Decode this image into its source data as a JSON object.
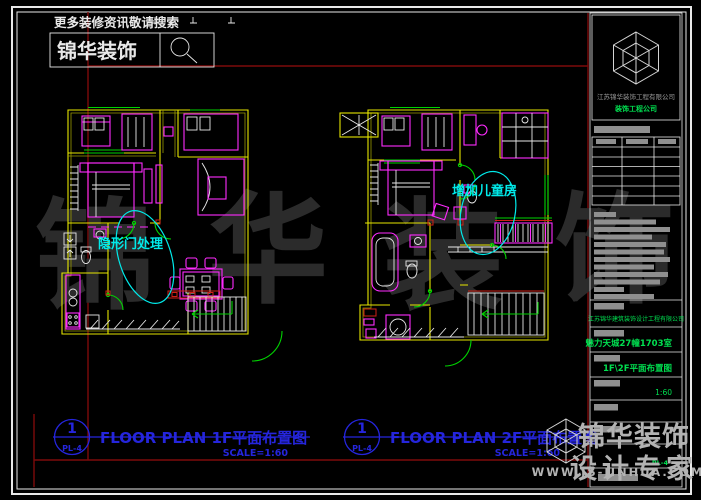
{
  "promo": {
    "hint": "更多装修资讯敬请搜索",
    "brand": "锦华装饰"
  },
  "plans": [
    {
      "bubble_no": "1",
      "bubble_ref": "PL-4",
      "title": "FLOOR PLAN 1F平面布置图",
      "scale": "SCALE=1:60",
      "annotation": "隐形门处理"
    },
    {
      "bubble_no": "1",
      "bubble_ref": "PL-4",
      "title": "FLOOR PLAN 2F平面布置图",
      "scale": "SCALE=1:60",
      "annotation": "增加儿童房"
    }
  ],
  "titleblock": {
    "company": "江苏锦华装饰工程有限公司",
    "company_sub": "装饰工程公司",
    "design_firm": "江苏锦华建筑装饰设计工程有限公司",
    "project": "魅力天城27幢1703室",
    "drawing_title": "1F\\2F平面布置图",
    "scale": "1:60",
    "sheet_no": "PL-4"
  },
  "watermarks": {
    "center_chars": [
      "锦",
      "华",
      "装",
      "饰"
    ],
    "brand": "锦华装饰",
    "tagline": "设计专家",
    "url": "WWW.JS-JINHUA.COM"
  },
  "colors": {
    "background": "#000000",
    "wall_yellow": "#e6e600",
    "furniture_magenta": "#ff2bff",
    "detail_white": "#e8e8e8",
    "door_green": "#00d400",
    "annotation_cyan": "#00eaea",
    "label_blue": "#2525dc",
    "frame_red": "#7e0a0a",
    "titleblock_green": "#00e050",
    "watermark_gray": "#b3b3b3"
  }
}
